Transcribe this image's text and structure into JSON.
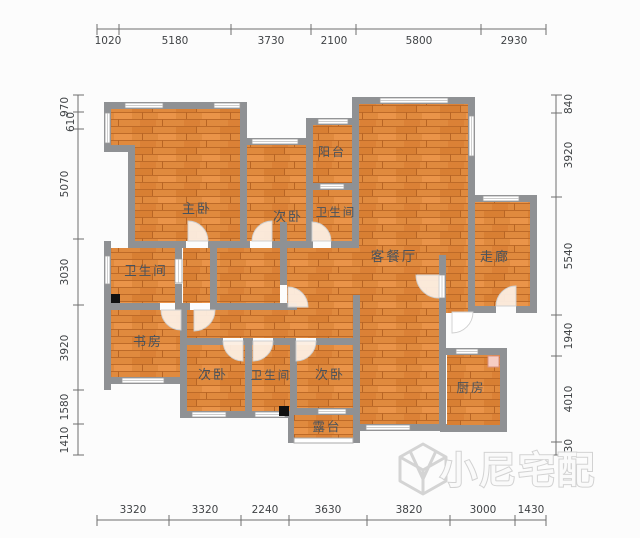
{
  "plan": {
    "rooms": [
      {
        "name": "master-bedroom",
        "label": "主卧"
      },
      {
        "name": "bedroom-top",
        "label": "次卧"
      },
      {
        "name": "balcony",
        "label": "阳台"
      },
      {
        "name": "bathroom-top",
        "label": "卫生间"
      },
      {
        "name": "living-dining-room",
        "label": "客餐厅"
      },
      {
        "name": "corridor",
        "label": "走廊"
      },
      {
        "name": "bathroom-left",
        "label": "卫生间"
      },
      {
        "name": "study",
        "label": "书房"
      },
      {
        "name": "bedroom-bottom-left",
        "label": "次卧"
      },
      {
        "name": "bathroom-bottom",
        "label": "卫生间"
      },
      {
        "name": "bedroom-bottom-right",
        "label": "次卧"
      },
      {
        "name": "kitchen",
        "label": "厨房"
      },
      {
        "name": "terrace",
        "label": "露台"
      }
    ]
  },
  "dimensions": {
    "top": [
      "1020",
      "5180",
      "3730",
      "2100",
      "5800",
      "2930"
    ],
    "bottom": [
      "3320",
      "3320",
      "2240",
      "3630",
      "3820",
      "3000",
      "1430"
    ],
    "left": [
      "970",
      "610",
      "5070",
      "3030",
      "3920",
      "1580",
      "1410"
    ],
    "right": [
      "840",
      "3920",
      "5540",
      "1940",
      "4010",
      "630"
    ]
  },
  "watermark": {
    "text": "小尼宅配"
  },
  "colors": {
    "floor": "#e08a3e",
    "floor_plank_dark": "#bd6a28",
    "wall": "#8f9194",
    "room_label_text": "#46525e",
    "dimension_text": "#3f4245",
    "watermark_outline": "#d2d2d2",
    "door_arc_fill": "#fceee1"
  }
}
